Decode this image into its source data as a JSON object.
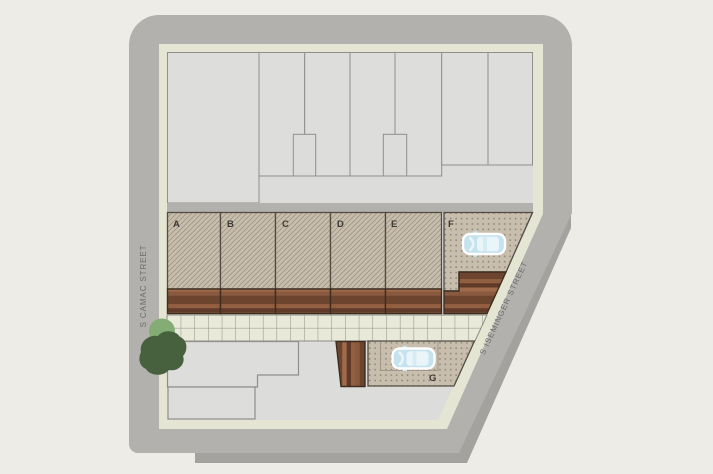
{
  "page_title": "Site plan of residential block",
  "streets": {
    "left": "S CAMAC STREET",
    "right": "S ISEMINGER STREET"
  },
  "lots": [
    {
      "label": "A",
      "surface": "hatched",
      "deck": "wood"
    },
    {
      "label": "B",
      "surface": "hatched",
      "deck": "wood"
    },
    {
      "label": "C",
      "surface": "hatched",
      "deck": "wood"
    },
    {
      "label": "D",
      "surface": "hatched",
      "deck": "wood"
    },
    {
      "label": "E",
      "surface": "hatched",
      "deck": "wood"
    },
    {
      "label": "F",
      "surface": "stippled-parking",
      "deck": "wood",
      "vehicle": "car"
    },
    {
      "label": "G",
      "surface": "stippled-parking",
      "deck": "wood",
      "vehicle": "car"
    }
  ],
  "icons": [
    {
      "name": "car-icon",
      "meaning": "parked car, top view",
      "color": "#c5e3ee"
    },
    {
      "name": "tree-icon",
      "meaning": "street tree canopy",
      "color": "#47613e"
    }
  ],
  "colors": {
    "bg": "#eeece6",
    "road": "#b2b1ae",
    "roadShadow": "#a3a29f",
    "walkEdge": "#e4e5d2",
    "base": "#dcdcda",
    "bld": "#dddddc",
    "bldLine": "#8f8f8c",
    "lot": "#c8beae",
    "hatchLine": "#a29783",
    "lotLine": "#524c43",
    "dot": "#8c8172",
    "deckLine": "#3c2d20",
    "wood1": "#6d452f",
    "wood2": "#935f41",
    "wood3": "#7a4e36",
    "wood4": "#a06b4a",
    "wood5": "#5f3a29",
    "wood6": "#8a5a40",
    "walk": "#e9e9d9",
    "walkLine": "#8e8e84",
    "padLine": "#a3988a",
    "carBody": "#c5e3ee",
    "carWindow": "#eaf5f9",
    "carOutline": "#ffffff",
    "treeDark": "#47613e",
    "treeLight": "#84ad75",
    "streetText": "#6c6c6a",
    "lotLabel": "#3c3a34"
  }
}
